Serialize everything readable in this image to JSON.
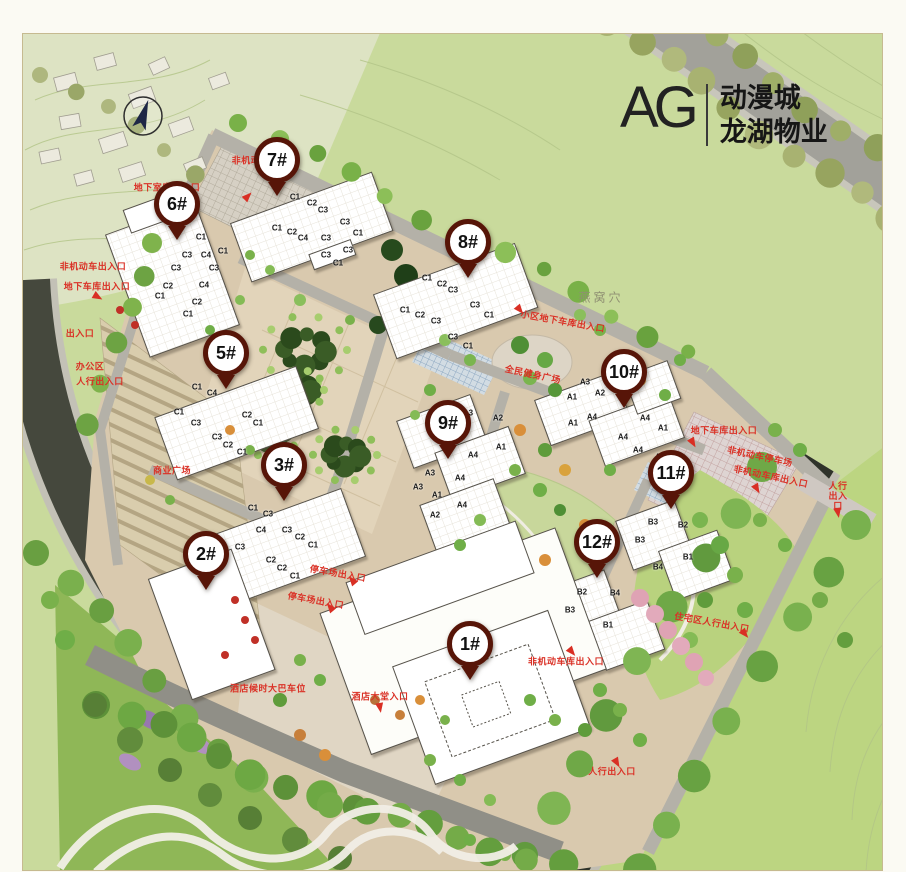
{
  "logo": {
    "mark": "AG",
    "title_line1": "动漫城",
    "title_line2": "龙湖物业"
  },
  "colors": {
    "pin_ring": "#571508",
    "annotation_red": "#da3126",
    "site_beige": "#d9c9ae",
    "field_green": "#c9da9c",
    "dark_road": "#2f332a",
    "building_white": "#ffffff"
  },
  "map": {
    "pins": [
      {
        "label": "1#",
        "x": 470,
        "y": 667
      },
      {
        "label": "2#",
        "x": 206,
        "y": 577
      },
      {
        "label": "3#",
        "x": 284,
        "y": 488
      },
      {
        "label": "5#",
        "x": 226,
        "y": 376
      },
      {
        "label": "6#",
        "x": 177,
        "y": 227
      },
      {
        "label": "7#",
        "x": 277,
        "y": 183
      },
      {
        "label": "8#",
        "x": 468,
        "y": 265
      },
      {
        "label": "9#",
        "x": 448,
        "y": 446
      },
      {
        "label": "10#",
        "x": 624,
        "y": 395
      },
      {
        "label": "11#",
        "x": 671,
        "y": 496
      },
      {
        "label": "12#",
        "x": 597,
        "y": 565
      }
    ],
    "annotations": [
      {
        "text": "非机动车停车场",
        "x": 265,
        "y": 160
      },
      {
        "text": "地下室库出入口",
        "x": 167,
        "y": 187
      },
      {
        "text": "非机动车出入口",
        "x": 93,
        "y": 266
      },
      {
        "text": "地下车库出入口",
        "x": 97,
        "y": 286
      },
      {
        "text": "出入口",
        "x": 80,
        "y": 333
      },
      {
        "text": "办公区",
        "x": 90,
        "y": 366
      },
      {
        "text": "人行出入口",
        "x": 100,
        "y": 381
      },
      {
        "text": "商业广场",
        "x": 172,
        "y": 470
      },
      {
        "text": "停车场出入口",
        "x": 338,
        "y": 573,
        "rot": 10
      },
      {
        "text": "停车场出入口",
        "x": 316,
        "y": 600,
        "rot": 10
      },
      {
        "text": "酒店候时大巴车位",
        "x": 268,
        "y": 688
      },
      {
        "text": "酒店大堂入口",
        "x": 380,
        "y": 696
      },
      {
        "text": "全民健身广场",
        "x": 533,
        "y": 374,
        "rot": 12
      },
      {
        "text": "小区地下车库出入口",
        "x": 563,
        "y": 321,
        "rot": 10
      },
      {
        "text": "地下车库出入口",
        "x": 724,
        "y": 430
      },
      {
        "text": "非机动车停车场",
        "x": 760,
        "y": 456,
        "rot": 12
      },
      {
        "text": "非机动车库出入口",
        "x": 771,
        "y": 476,
        "rot": 12
      },
      {
        "text": "人行出入口",
        "x": 838,
        "y": 497,
        "w": 26
      },
      {
        "text": "住宅区人行出入口",
        "x": 712,
        "y": 622,
        "rot": 10
      },
      {
        "text": "非机动车库出入口",
        "x": 566,
        "y": 661
      },
      {
        "text": "人行出入口",
        "x": 612,
        "y": 771
      }
    ],
    "area_labels": [
      {
        "text": "燕窝穴",
        "x": 601,
        "y": 297
      }
    ],
    "arrows": [
      {
        "x": 248,
        "y": 196,
        "r": 45
      },
      {
        "x": 163,
        "y": 199,
        "r": 60
      },
      {
        "x": 98,
        "y": 297,
        "r": 120
      },
      {
        "x": 352,
        "y": 580,
        "r": -40
      },
      {
        "x": 330,
        "y": 607,
        "r": -40
      },
      {
        "x": 380,
        "y": 708,
        "r": 170
      },
      {
        "x": 520,
        "y": 310,
        "r": 140
      },
      {
        "x": 693,
        "y": 443,
        "r": 150
      },
      {
        "x": 757,
        "y": 489,
        "r": 150
      },
      {
        "x": 838,
        "y": 513,
        "r": 170
      },
      {
        "x": 572,
        "y": 652,
        "r": 140
      },
      {
        "x": 617,
        "y": 763,
        "r": 150
      },
      {
        "x": 745,
        "y": 634,
        "r": 140
      }
    ],
    "unit_labels": [
      {
        "t": "C1",
        "x": 201,
        "y": 237
      },
      {
        "t": "C1",
        "x": 223,
        "y": 251
      },
      {
        "t": "C3",
        "x": 187,
        "y": 255
      },
      {
        "t": "C4",
        "x": 206,
        "y": 255
      },
      {
        "t": "C3",
        "x": 176,
        "y": 268
      },
      {
        "t": "C3",
        "x": 214,
        "y": 268
      },
      {
        "t": "C2",
        "x": 168,
        "y": 286
      },
      {
        "t": "C4",
        "x": 204,
        "y": 285
      },
      {
        "t": "C1",
        "x": 160,
        "y": 296
      },
      {
        "t": "C2",
        "x": 197,
        "y": 302
      },
      {
        "t": "C1",
        "x": 188,
        "y": 314
      },
      {
        "t": "C1",
        "x": 295,
        "y": 197
      },
      {
        "t": "C2",
        "x": 312,
        "y": 203
      },
      {
        "t": "C3",
        "x": 323,
        "y": 210
      },
      {
        "t": "C1",
        "x": 277,
        "y": 228
      },
      {
        "t": "C3",
        "x": 345,
        "y": 222
      },
      {
        "t": "C2",
        "x": 292,
        "y": 232
      },
      {
        "t": "C4",
        "x": 303,
        "y": 238
      },
      {
        "t": "C3",
        "x": 326,
        "y": 238
      },
      {
        "t": "C1",
        "x": 358,
        "y": 233
      },
      {
        "t": "C3",
        "x": 326,
        "y": 255
      },
      {
        "t": "C1",
        "x": 338,
        "y": 263
      },
      {
        "t": "C3",
        "x": 348,
        "y": 250
      },
      {
        "t": "C1",
        "x": 427,
        "y": 278
      },
      {
        "t": "C2",
        "x": 442,
        "y": 284
      },
      {
        "t": "C3",
        "x": 453,
        "y": 290
      },
      {
        "t": "C3",
        "x": 475,
        "y": 305
      },
      {
        "t": "C1",
        "x": 405,
        "y": 310
      },
      {
        "t": "C2",
        "x": 420,
        "y": 315
      },
      {
        "t": "C3",
        "x": 436,
        "y": 321
      },
      {
        "t": "C1",
        "x": 489,
        "y": 315
      },
      {
        "t": "C3",
        "x": 453,
        "y": 337
      },
      {
        "t": "C1",
        "x": 468,
        "y": 346
      },
      {
        "t": "C1",
        "x": 197,
        "y": 387
      },
      {
        "t": "C4",
        "x": 212,
        "y": 393
      },
      {
        "t": "C1",
        "x": 179,
        "y": 412
      },
      {
        "t": "C3",
        "x": 196,
        "y": 423
      },
      {
        "t": "C2",
        "x": 247,
        "y": 415
      },
      {
        "t": "C1",
        "x": 258,
        "y": 423
      },
      {
        "t": "C3",
        "x": 217,
        "y": 437
      },
      {
        "t": "C2",
        "x": 228,
        "y": 445
      },
      {
        "t": "C1",
        "x": 242,
        "y": 452
      },
      {
        "t": "C1",
        "x": 253,
        "y": 508
      },
      {
        "t": "C3",
        "x": 268,
        "y": 514
      },
      {
        "t": "C4",
        "x": 261,
        "y": 530
      },
      {
        "t": "C3",
        "x": 287,
        "y": 530
      },
      {
        "t": "C2",
        "x": 300,
        "y": 537
      },
      {
        "t": "C1",
        "x": 313,
        "y": 545
      },
      {
        "t": "C3",
        "x": 240,
        "y": 547
      },
      {
        "t": "C2",
        "x": 271,
        "y": 560
      },
      {
        "t": "C2",
        "x": 282,
        "y": 568
      },
      {
        "t": "C1",
        "x": 295,
        "y": 576
      },
      {
        "t": "A3",
        "x": 468,
        "y": 413
      },
      {
        "t": "A2",
        "x": 498,
        "y": 418
      },
      {
        "t": "A3",
        "x": 458,
        "y": 425
      },
      {
        "t": "A1",
        "x": 501,
        "y": 447
      },
      {
        "t": "A4",
        "x": 473,
        "y": 455
      },
      {
        "t": "A3",
        "x": 430,
        "y": 473
      },
      {
        "t": "A4",
        "x": 460,
        "y": 478
      },
      {
        "t": "A3",
        "x": 418,
        "y": 487
      },
      {
        "t": "A1",
        "x": 437,
        "y": 495
      },
      {
        "t": "A4",
        "x": 462,
        "y": 505
      },
      {
        "t": "A2",
        "x": 435,
        "y": 515
      },
      {
        "t": "A3",
        "x": 585,
        "y": 382
      },
      {
        "t": "A2",
        "x": 600,
        "y": 393
      },
      {
        "t": "A1",
        "x": 572,
        "y": 397
      },
      {
        "t": "A4",
        "x": 592,
        "y": 417
      },
      {
        "t": "A1",
        "x": 573,
        "y": 423
      },
      {
        "t": "A4",
        "x": 645,
        "y": 418
      },
      {
        "t": "A4",
        "x": 623,
        "y": 437
      },
      {
        "t": "A1",
        "x": 663,
        "y": 428
      },
      {
        "t": "A4",
        "x": 638,
        "y": 450
      },
      {
        "t": "A2",
        "x": 660,
        "y": 457
      },
      {
        "t": "B3",
        "x": 653,
        "y": 522
      },
      {
        "t": "B2",
        "x": 683,
        "y": 525
      },
      {
        "t": "B3",
        "x": 640,
        "y": 540
      },
      {
        "t": "B1",
        "x": 688,
        "y": 557
      },
      {
        "t": "B4",
        "x": 658,
        "y": 567
      },
      {
        "t": "B2",
        "x": 582,
        "y": 592
      },
      {
        "t": "B4",
        "x": 615,
        "y": 593
      },
      {
        "t": "B3",
        "x": 570,
        "y": 610
      },
      {
        "t": "B1",
        "x": 608,
        "y": 625
      }
    ]
  }
}
